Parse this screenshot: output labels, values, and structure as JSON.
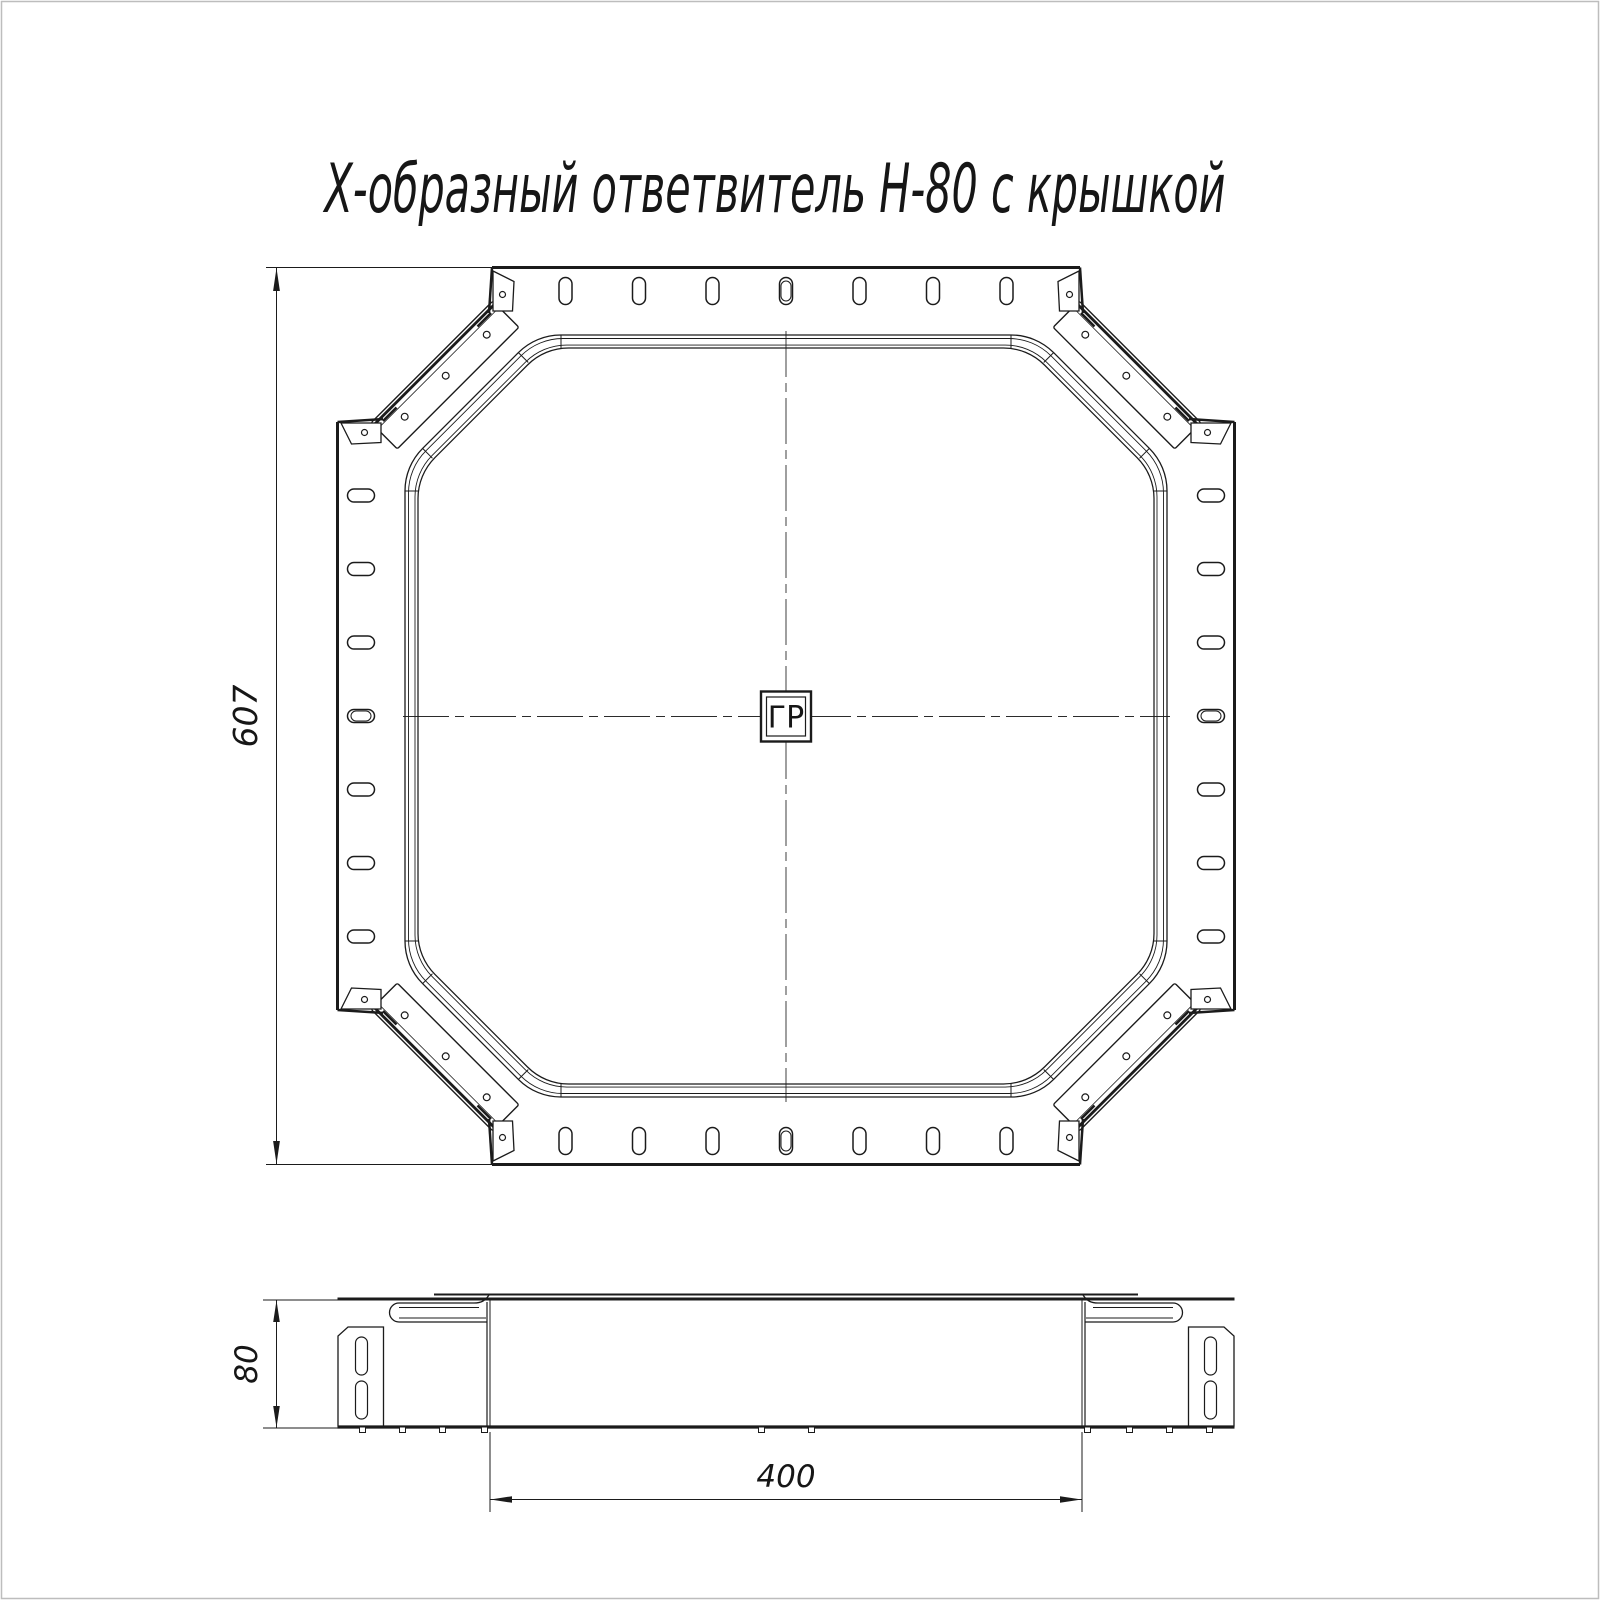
{
  "page": {
    "width": 1600,
    "height": 1600,
    "background": "#ffffff",
    "frame_color": "#bdbdbd"
  },
  "title": {
    "text": "Х-образный ответвитель Н-80 с крышкой"
  },
  "top_view": {
    "label": "top-view",
    "overall_dimension": "607",
    "center_mark": "ГР",
    "slots_per_side": 7,
    "corner_straps": 4,
    "strap_holes_each": 3
  },
  "side_view": {
    "label": "side-view",
    "height_dimension": "80",
    "width_dimension": "400"
  },
  "colors": {
    "line": "#1b1b1b",
    "centerline": "#2b2b2b",
    "text": "#161616"
  }
}
